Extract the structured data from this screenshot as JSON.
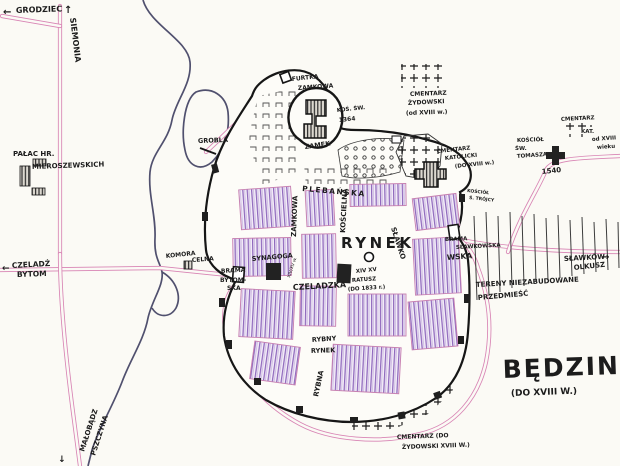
{
  "title": {
    "name": "BĘDZIN",
    "period": "(DO XVIII W.)"
  },
  "icons": {
    "arrow_left": "←",
    "arrow_up": "↑",
    "arrow_right": "→",
    "arrow_down": "↓"
  },
  "roads": {
    "grodziec": "GRODZIEC",
    "siemonia": "SIEMONIA",
    "czeladz": "CZELADŹ",
    "bytom": "BYTOM",
    "malobadz": "MAŁOBĄDZ",
    "pszczyna": "PSZCZYNA",
    "slawkow": "SŁAWKÓW",
    "olkusz": "OLKUSZ"
  },
  "streets": {
    "rynek": "RYNEK",
    "zamkowa": "ZAMKOWA",
    "plebanska": "PLEBAŃSKA",
    "koscielna": "KOŚCIELNA",
    "slawkowska_inner": "SŁAWKO",
    "slawkowska_outer": "WSKA",
    "czeladzka": "CZELADZKA",
    "rybna": "RYBNA",
    "rybny_rynek_1": "RYBNY",
    "rybny_rynek_2": "RYNEK"
  },
  "landmarks": {
    "palac_1": "PAŁAC HR.",
    "palac_2": "MIEROSZEWSKICH",
    "komora": "KOMORA",
    "celna": "CELNA",
    "synagoga": "SYNAGOGA",
    "synagoga_date": "XIV/XV w.",
    "grobla": "GROBLA",
    "zamek": "ZAMEK",
    "zamek_kosciol": "KOŚ. ŚW.",
    "zamek_kosciol_date": "1364",
    "furtka_1": "FURTKA",
    "furtka_2": "ZAMKOWA",
    "brama_bytomska_1": "BRAMA",
    "brama_bytomska_2": "BYTOM-",
    "brama_bytomska_3": "SKA",
    "brama_slawkowska_1": "BRAMA",
    "brama_slawkowska_2": "SŁAWKOWSKA",
    "ratusz_1": "XIV XV",
    "ratusz_2": "RATUSZ",
    "ratusz_3": "(DO 1833 r.)",
    "kosciol_trojcy_1": "KOŚCIÓŁ",
    "kosciol_trojcy_2": "Ś. TRÓJCY",
    "kosciol_tomasza_1": "KOŚCIÓŁ",
    "kosciol_tomasza_2": "ŚW.",
    "kosciol_tomasza_3": "TOMASZA",
    "kosciol_tomasza_date": "1540"
  },
  "cemeteries": {
    "zydowski_top_1": "CMENTARZ",
    "zydowski_top_2": "ŻYDOWSKI",
    "zydowski_top_3": "(od XVIII w.)",
    "katolicki_hill_1": "CMENTARZ",
    "katolicki_hill_2": "KATOLICKI",
    "katolicki_hill_3": "(DO XVIII w.)",
    "katolicki_new_1": "CMENTARZ",
    "katolicki_new_2": "KAT.",
    "katolicki_new_3": "od XVIII",
    "katolicki_new_4": "wieku",
    "zydowski_bottom_1": "CMENTARZ (DO",
    "zydowski_bottom_2": "ŻYDOWSKI XVIII W.)"
  },
  "areas": {
    "tereny_1": "TERENY NIEZABUDOWANE",
    "tereny_2": "PRZEDMIEŚĆ"
  },
  "colors": {
    "paper": "#fbfaf5",
    "ink": "#1c1c1c",
    "road_pink": "#d884b4",
    "river_blue": "#50506e",
    "block_purple": "#8f68bd"
  }
}
